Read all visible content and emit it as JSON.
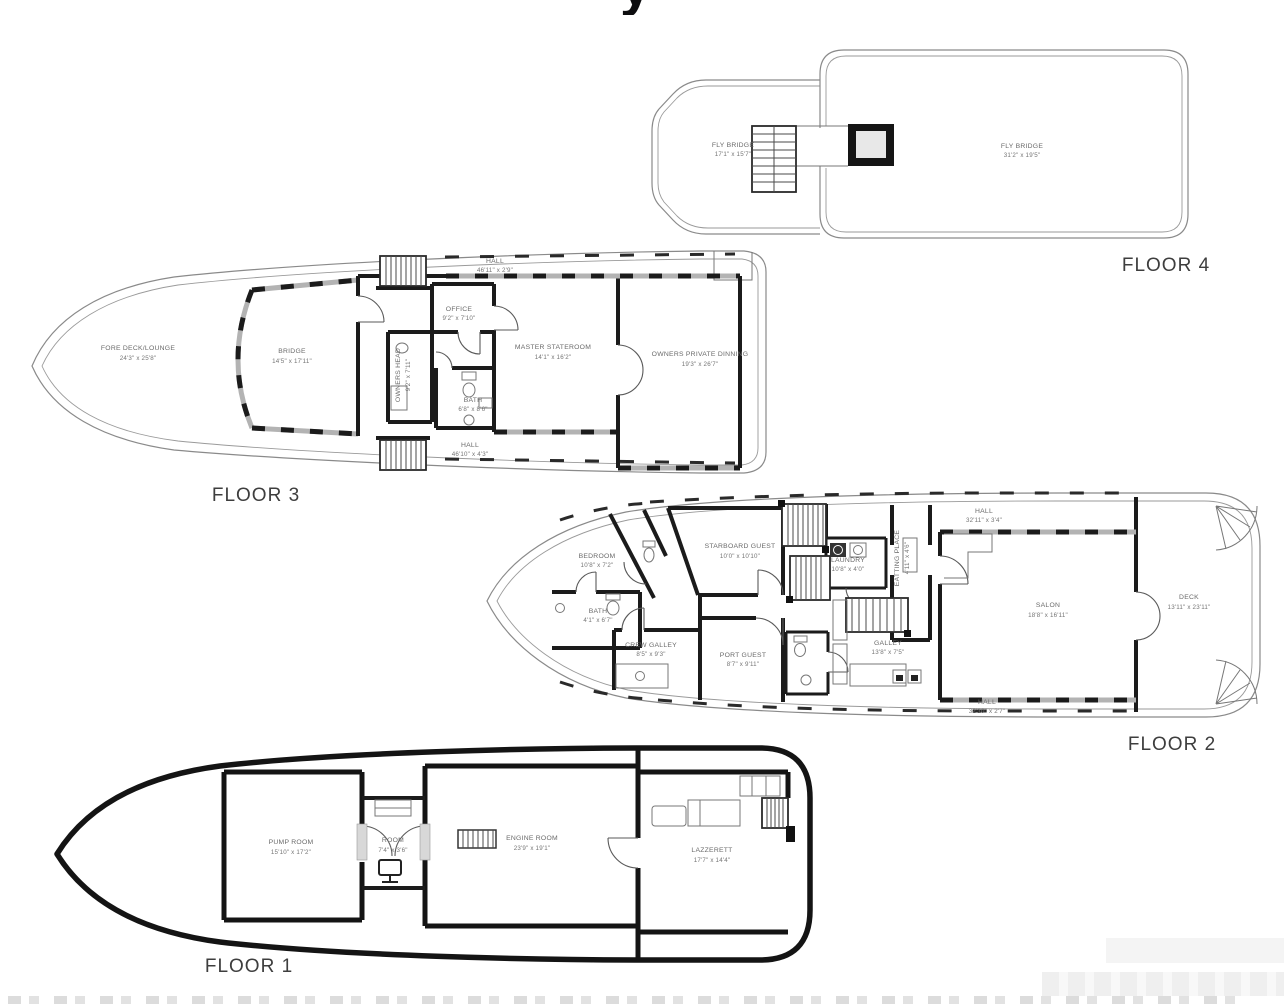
{
  "page": {
    "background": "#ffffff",
    "title_fragment": "y"
  },
  "floors": {
    "floor4": {
      "label": "FLOOR 4",
      "rooms": [
        {
          "name": "FLY BRIDGE",
          "dims": "17'1\" x 15'7\""
        },
        {
          "name": "FLY BRIDGE",
          "dims": "31'2\" x 19'5\""
        }
      ]
    },
    "floor3": {
      "label": "FLOOR 3",
      "rooms": [
        {
          "name": "FORE DECK/LOUNGE",
          "dims": "24'3\" x 25'8\""
        },
        {
          "name": "BRIDGE",
          "dims": "14'5\" x 17'11\""
        },
        {
          "name": "HALL",
          "dims": "46'11\" x 2'9\""
        },
        {
          "name": "OFFICE",
          "dims": "9'2\" x 7'10\""
        },
        {
          "name": "OWNERS HEAD",
          "dims": "9'2\" x 7'11\""
        },
        {
          "name": "MASTER STATEROOM",
          "dims": "14'1\" x 16'2\""
        },
        {
          "name": "OWNERS PRIVATE DINNING",
          "dims": "19'3\" x 26'7\""
        },
        {
          "name": "BATH",
          "dims": "6'8\" x 8'6\""
        },
        {
          "name": "HALL",
          "dims": "46'10\" x 4'3\""
        }
      ]
    },
    "floor2": {
      "label": "FLOOR 2",
      "rooms": [
        {
          "name": "BEDROOM",
          "dims": "10'8\" x 7'2\""
        },
        {
          "name": "STARBOARD GUEST",
          "dims": "10'0\" x 10'10\""
        },
        {
          "name": "BATH",
          "dims": "4'1\" x 6'7\""
        },
        {
          "name": "CREW GALLEY",
          "dims": "8'5\" x 9'3\""
        },
        {
          "name": "PORT GUEST",
          "dims": "8'7\" x 9'11\""
        },
        {
          "name": "LAUNDRY",
          "dims": "10'8\" x 4'0\""
        },
        {
          "name": "EATTING PLACE",
          "dims": "4'11\" x 4'6\""
        },
        {
          "name": "HALL",
          "dims": "32'11\" x 3'4\""
        },
        {
          "name": "GALLEY",
          "dims": "13'8\" x 7'5\""
        },
        {
          "name": "SALON",
          "dims": "18'8\" x 16'11\""
        },
        {
          "name": "DECK",
          "dims": "13'11\" x 23'11\""
        },
        {
          "name": "HALL",
          "dims": "32'10\" x 2'7\""
        }
      ]
    },
    "floor1": {
      "label": "FLOOR 1",
      "rooms": [
        {
          "name": "PUMP ROOM",
          "dims": "15'10\" x 17'2\""
        },
        {
          "name": "ROOM",
          "dims": "7'4\" x 3'6\""
        },
        {
          "name": "ENGINE ROOM",
          "dims": "23'9\" x 19'1\""
        },
        {
          "name": "LAZZERETT",
          "dims": "17'7\" x 14'4\""
        }
      ]
    }
  }
}
